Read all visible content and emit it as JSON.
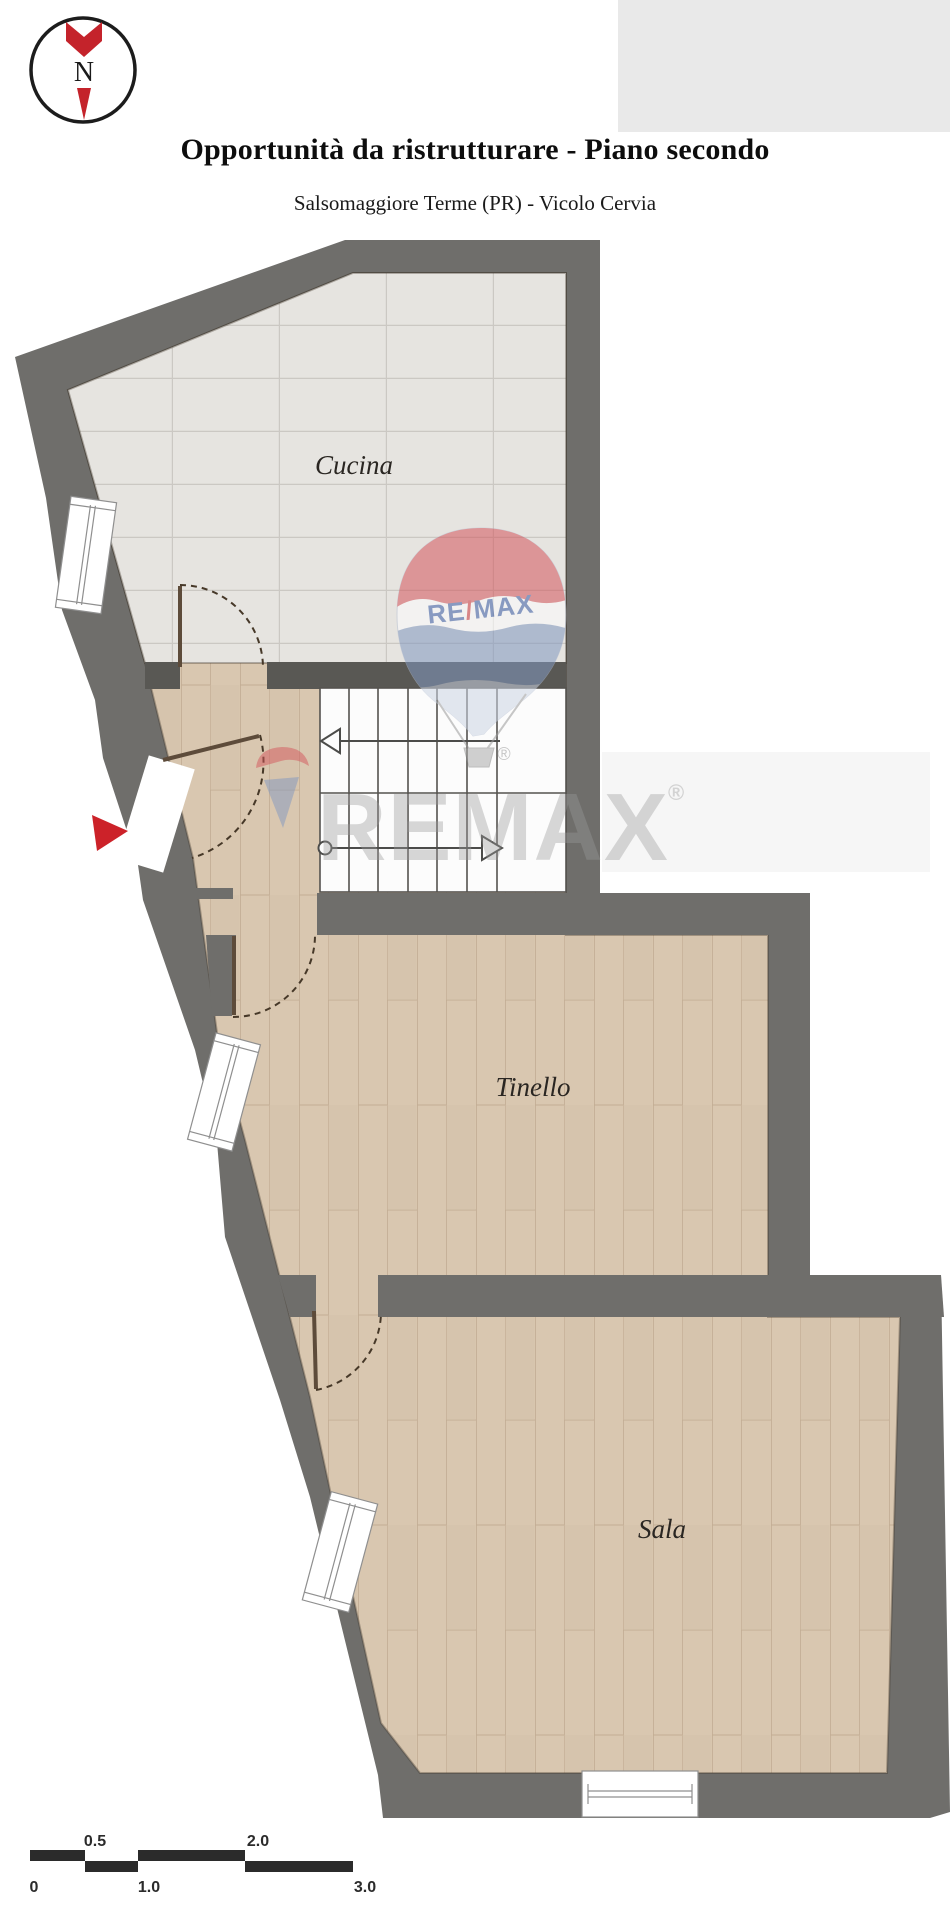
{
  "header": {
    "title": "Opportunità da ristrutturare - Piano secondo",
    "subtitle": "Salsomaggiore Terme (PR) - Vicolo Cervia"
  },
  "compass": {
    "north_letter": "N"
  },
  "floorplan": {
    "rooms": [
      {
        "label": "Cucina"
      },
      {
        "label": "Tinello"
      },
      {
        "label": "Sala"
      }
    ]
  },
  "watermark": {
    "balloon_re": "RE",
    "balloon_slash": "/",
    "balloon_max": "MAX",
    "big_text": "REMAX",
    "registered": "®"
  },
  "scale_bar": {
    "above": [
      "0.5",
      "2.0"
    ],
    "below": [
      "0",
      "1.0",
      "3.0"
    ]
  },
  "colors": {
    "wall": "#6f6e6b",
    "tile_floor": "#e6e4e0",
    "wood_floor": "#d9c7b0",
    "accent_red": "#cc2229",
    "balloon_red": "#d4565c",
    "balloon_blue": "#8298c0",
    "logo_blue": "#3c5fa8",
    "watermark_gray": "#9b9b9b"
  }
}
